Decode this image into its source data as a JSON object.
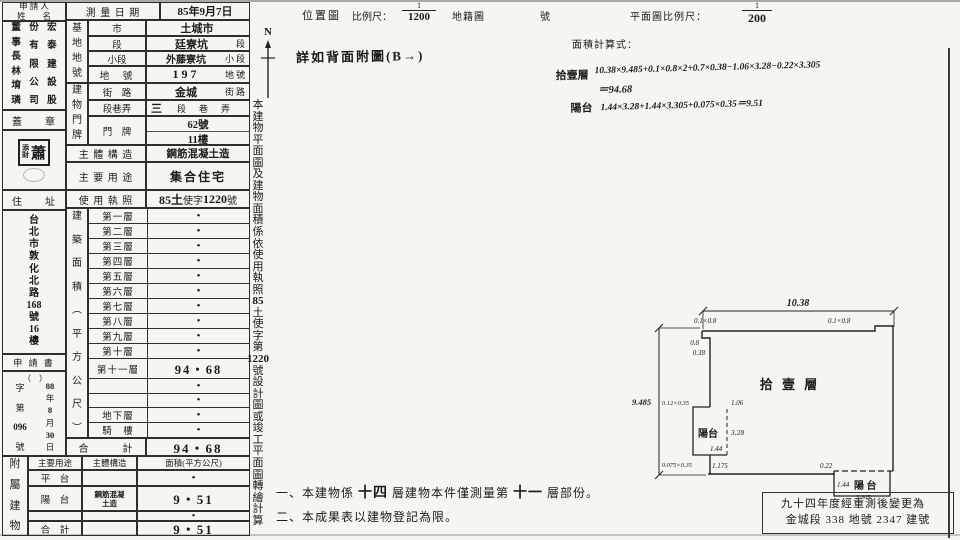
{
  "applicant": {
    "title_l1": "申 請 人",
    "title_l2": "姓　　名",
    "name_cols": [
      [
        "董事長林堉璘"
      ],
      [
        "份有限公司"
      ],
      [
        "宏泰建設股"
      ]
    ],
    "seal_title": "蓋　　章",
    "stamp_small": "添財",
    "stamp_big": "蕭",
    "addr_title": "住　　址",
    "address": [
      "台北市敦化北路",
      "168",
      "號",
      "16",
      "樓"
    ],
    "app_title": "申 請 書",
    "app_paren": "（　）",
    "app_no_col": [
      "字第",
      "096",
      "號"
    ],
    "app_date_col": [
      "88",
      "年",
      "8",
      "月",
      "30",
      "日"
    ]
  },
  "survey": {
    "label": "測 量 日 期",
    "value": "85年9月7日"
  },
  "site": {
    "group": [
      "基地地號"
    ],
    "rows": [
      {
        "label": "市",
        "value": "土城市",
        "suffix": ""
      },
      {
        "label": "段",
        "value": "廷寮坑",
        "suffix": "段"
      },
      {
        "label": "小段",
        "value": "外藤寮坑",
        "suffix": "小段"
      },
      {
        "label": "地　號",
        "value": "197",
        "suffix": "地號"
      }
    ]
  },
  "door": {
    "group": [
      "建物門牌"
    ],
    "street_label": "街　路",
    "street": "金城",
    "street_suffix": "街路",
    "sect_label": "段巷弄",
    "sect": "三",
    "sect_suffix": "段　巷　弄",
    "plate_label": "門　牌",
    "plate1": "62號",
    "plate2": "11樓"
  },
  "structure": {
    "label": "主 體 構 造",
    "value": "鋼筋混凝土造"
  },
  "usage": {
    "label": "主 要 用 途",
    "value": "集合住宅"
  },
  "license": {
    "label": "使 用 執 照",
    "p1": "85土",
    "p2": "使字",
    "p3": "1220",
    "p4": "號"
  },
  "floor_area": {
    "group": [
      "建築面積︵平方公尺︶"
    ],
    "rows": [
      {
        "label": "第一層",
        "value": "•"
      },
      {
        "label": "第二層",
        "value": "•"
      },
      {
        "label": "第三層",
        "value": "•"
      },
      {
        "label": "第四層",
        "value": "•"
      },
      {
        "label": "第五層",
        "value": "•"
      },
      {
        "label": "第六層",
        "value": "•"
      },
      {
        "label": "第七層",
        "value": "•"
      },
      {
        "label": "第八層",
        "value": "•"
      },
      {
        "label": "第九層",
        "value": "•"
      },
      {
        "label": "第十層",
        "value": "•"
      },
      {
        "label": "第十一層",
        "value": "94・68",
        "hw": true
      },
      {
        "label": "",
        "value": "•"
      },
      {
        "label": "",
        "value": "•"
      },
      {
        "label": "地下層",
        "value": "•"
      },
      {
        "label": "騎　樓",
        "value": "•"
      }
    ],
    "total_label": "合　　　計",
    "total": "94・68"
  },
  "annex": {
    "side": [
      "附屬建物"
    ],
    "h_use": "主要用途",
    "h_struct": "主體構造",
    "h_area": "面積(平方公尺)",
    "rows": [
      {
        "use": "平　台",
        "struct": "",
        "area": "•"
      },
      {
        "use": "陽　台",
        "struct": "鋼筋混凝土造",
        "area": "9・51"
      },
      {
        "use": "",
        "struct": "",
        "area": "•"
      },
      {
        "use": "合　計",
        "struct": "",
        "area": "9・51"
      }
    ]
  },
  "topbar": {
    "loc": "位置圖",
    "scale_label": "比例尺：",
    "scale_num": "1",
    "scale_den": "1200",
    "cadastral": "地籍圖",
    "no": "號",
    "plan_scale_label": "平面圖比例尺：",
    "plan_num": "1",
    "plan_den": "200"
  },
  "rightcol": {
    "compass": "N",
    "strip": [
      "本建物平面圖及建物面積係依使用執照",
      "85",
      "土使字第",
      "1220",
      "號設計圖或竣工平面圖轉繪計算"
    ]
  },
  "back_note": "詳如背面附圖(B→)",
  "calc": {
    "title": "面積計算式：",
    "l1_label": "拾壹層",
    "l1": "10.38×9.485+0.1×0.8×2+0.7×0.38−1.06×3.28−0.22×3.305",
    "l2": "＝94.68",
    "l3_label": "陽台",
    "l3": "1.44×3.28+1.44×3.305+0.075×0.35＝9.51"
  },
  "plan": {
    "main_label": "拾 壹 層",
    "balcony_left": "陽台",
    "balcony_right": "陽 台",
    "dims": {
      "top": "10.38",
      "left": "9.485",
      "tl_notch": "0.1×0.8",
      "tr_notch": "0.1×0.8",
      "v08": "0.8",
      "v038": "0.38",
      "b1": "0.12×0.35",
      "b2": "1.06",
      "b3": "3.28",
      "b4": "1.44",
      "b5": "0.075×0.35",
      "b6": "1.175",
      "r1": "0.22",
      "r2": "1.44",
      "r3": "3.305"
    }
  },
  "notes": {
    "n1_pre": "一、本建物係",
    "n1_b1": "十四",
    "n1_mid": "層建物本件僅測量第",
    "n1_b2": "十一",
    "n1_post": "層部份。",
    "n2": "二、本成果表以建物登記為限。"
  },
  "remark": {
    "line1": "九十四年度經重測後變更為",
    "line2": "金城段 338 地號 2347 建號"
  }
}
